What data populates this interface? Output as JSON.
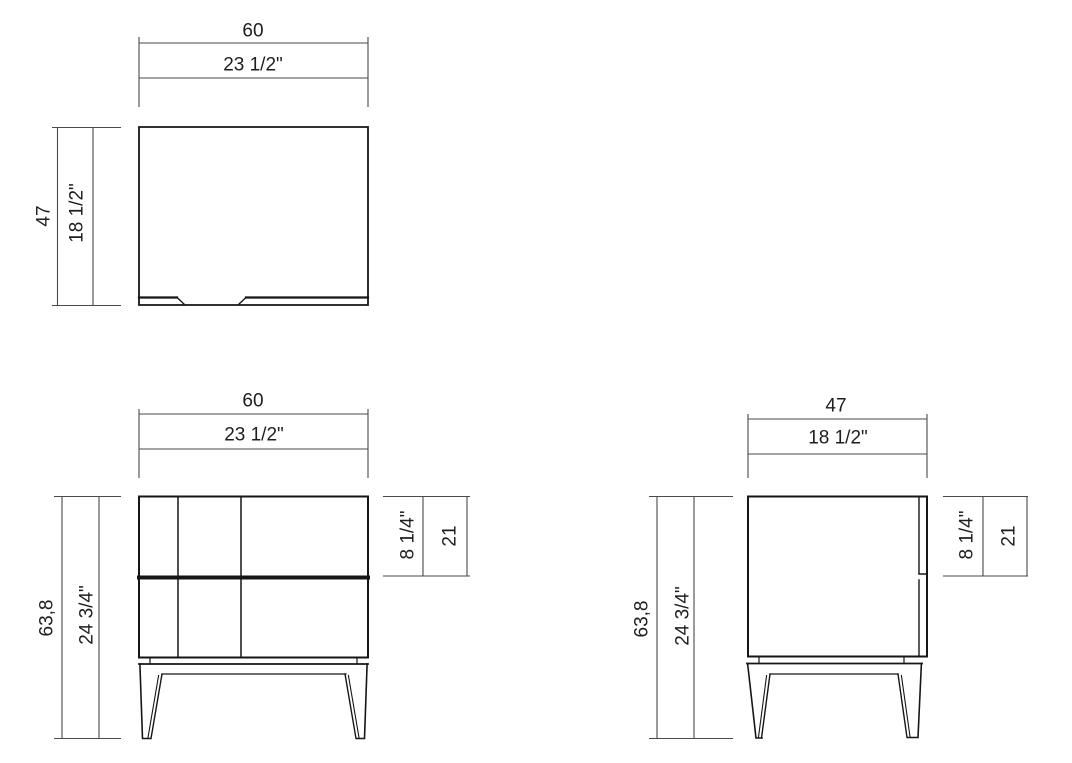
{
  "drawing": {
    "top_view": {
      "width_cm": "60",
      "width_in": "23 1/2\"",
      "depth_cm": "47",
      "depth_in": "18 1/2\""
    },
    "front_view": {
      "width_cm": "60",
      "width_in": "23 1/2\"",
      "total_height_cm": "63,8",
      "total_height_in": "24 3/4\"",
      "top_section_in": "8 1/4\"",
      "top_section_cm": "21"
    },
    "side_view": {
      "depth_cm": "47",
      "depth_in": "18 1/2\"",
      "total_height_cm": "63,8",
      "total_height_in": "24 3/4\"",
      "top_section_in": "8 1/4\"",
      "top_section_cm": "21"
    },
    "colors": {
      "object_line": "#161616",
      "dimension_line": "#4a4a4a",
      "text": "#1e1e1e",
      "background": "#ffffff"
    }
  }
}
